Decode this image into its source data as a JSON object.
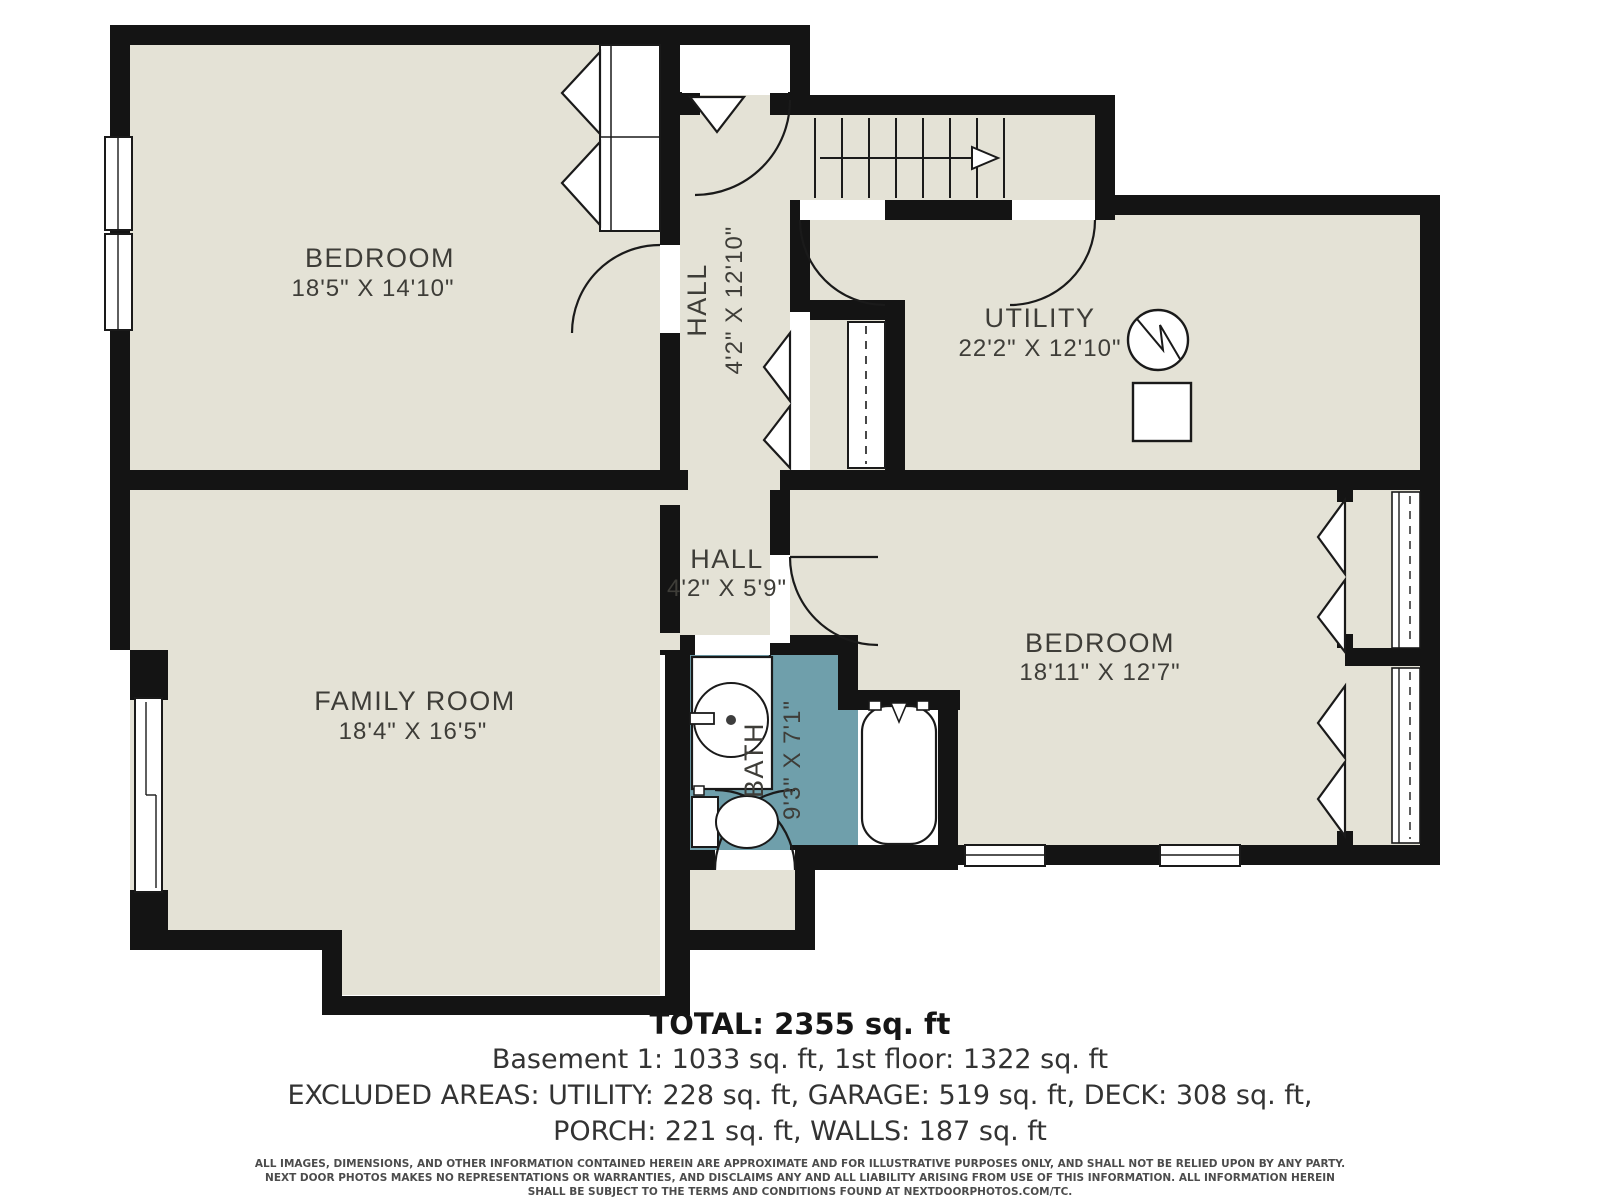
{
  "rooms": {
    "bedroom1": {
      "name": "BEDROOM",
      "dims": "18'5\" X 14'10\""
    },
    "hall1": {
      "name": "HALL",
      "dims": "4'2\" X 12'10\""
    },
    "utility": {
      "name": "UTILITY",
      "dims": "22'2\" X 12'10\""
    },
    "hall2": {
      "name": "HALL",
      "dims": "4'2\" X 5'9\""
    },
    "family": {
      "name": "FAMILY ROOM",
      "dims": "18'4\" X 16'5\""
    },
    "bath": {
      "name": "BATH",
      "dims": "9'3\" X 7'1\""
    },
    "bedroom2": {
      "name": "BEDROOM",
      "dims": "18'11\" X 12'7\""
    }
  },
  "summary": {
    "total": "TOTAL: 2355 sq. ft",
    "floors": "Basement 1: 1033 sq. ft, 1st floor: 1322 sq. ft",
    "excluded1": "EXCLUDED AREAS: UTILITY: 228 sq. ft, GARAGE: 519 sq. ft, DECK: 308 sq. ft,",
    "excluded2": "PORCH: 221 sq. ft, WALLS: 187 sq. ft"
  },
  "disclaimer": {
    "line1": "ALL IMAGES, DIMENSIONS, AND OTHER INFORMATION CONTAINED HEREIN ARE APPROXIMATE AND FOR ILLUSTRATIVE PURPOSES ONLY, AND SHALL NOT BE RELIED UPON BY ANY PARTY.",
    "line2": "NEXT DOOR PHOTOS MAKES NO REPRESENTATIONS OR WARRANTIES, AND DISCLAIMS ANY AND ALL LIABILITY ARISING FROM USE OF THIS INFORMATION. ALL INFORMATION HEREIN",
    "line3": "SHALL BE SUBJECT TO THE TERMS AND CONDITIONS FOUND AT NEXTDOORPHOTOS.COM/TC."
  },
  "colors": {
    "floor": "#e4e2d6",
    "bath_floor": "#6f9fab",
    "wall": "#141414",
    "label": "#3e3d38"
  }
}
